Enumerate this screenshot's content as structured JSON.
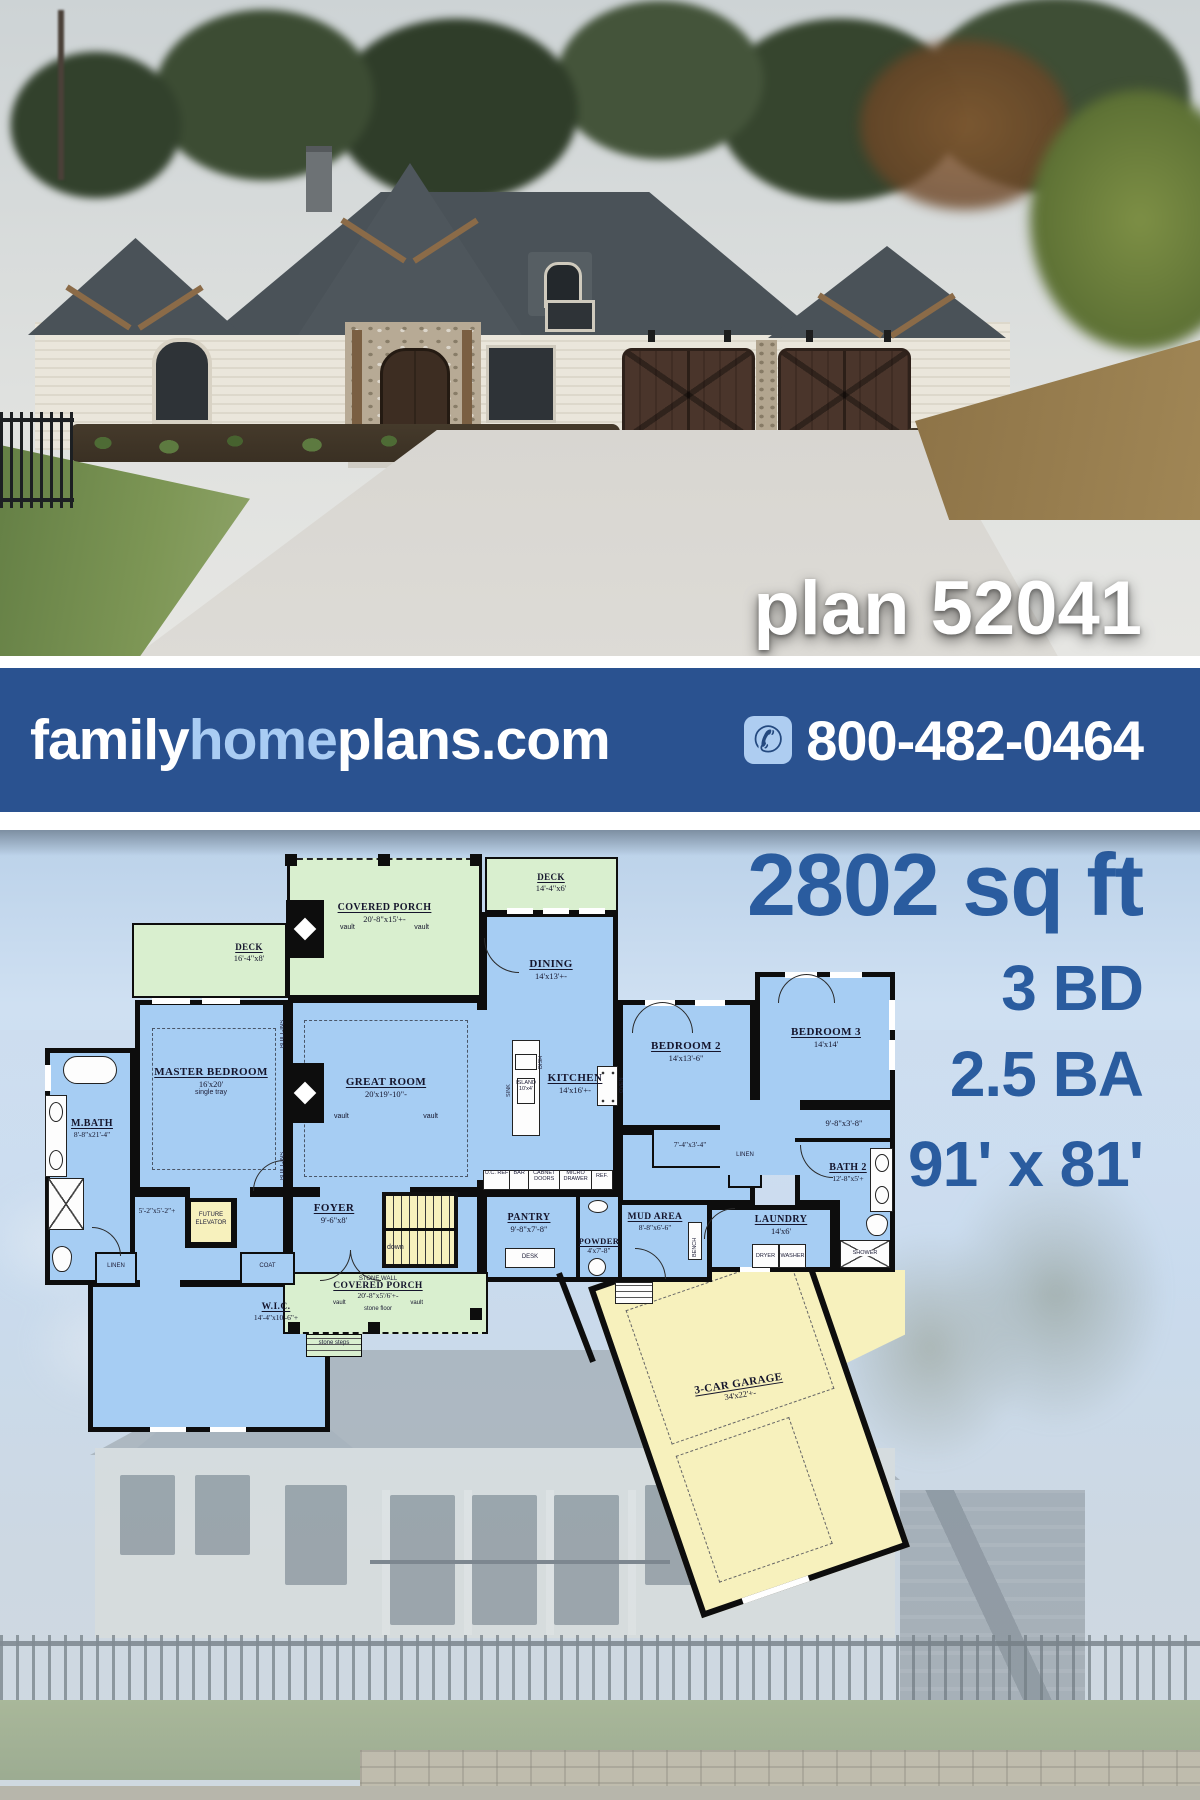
{
  "hero": {
    "plan_label": "plan 52041"
  },
  "banner": {
    "brand": {
      "family": "family",
      "home": "home",
      "plans": "plans.com"
    },
    "phone": "800-482-0464",
    "bg_color": "#2a5290",
    "home_color": "#a9ccf3"
  },
  "stats": {
    "area": "2802 sq ft",
    "beds": "3 BD",
    "baths": "2.5 BA",
    "size": "91' x 81'",
    "color": "#2a5c9f"
  },
  "plan": {
    "colors": {
      "room_blue": "#a6cdf3",
      "porch_green": "#d9efcf",
      "garage_yellow": "#f7f1bd",
      "wall": "#0d0d0d"
    },
    "porch_top": {
      "name": "COVERED PORCH",
      "dim": "20'-8\"x15'+-",
      "vault_l": "vault",
      "vault_r": "vault"
    },
    "deck_left": {
      "name": "DECK",
      "dim": "16'-4\"x8'"
    },
    "deck_right": {
      "name": "DECK",
      "dim": "14'-4\"x6'"
    },
    "dining": {
      "name": "DINING",
      "dim": "14'x13'+-"
    },
    "master": {
      "name": "MASTER BEDROOM",
      "dim": "16'x20'",
      "note": "single tray"
    },
    "great": {
      "name": "GREAT ROOM",
      "dim": "20'x19'-10\"-",
      "vault_l": "vault",
      "vault_r": "vault"
    },
    "kitchen": {
      "name": "KITCHEN",
      "dim": "14'x16'+-"
    },
    "island": {
      "name": "ISLAND",
      "dim": "10'x4'"
    },
    "mbath": {
      "name": "M.BATH",
      "dim": "8'-8\"x21'-4\""
    },
    "bedroom2": {
      "name": "BEDROOM 2",
      "dim": "14'x13'-6\""
    },
    "bedroom3": {
      "name": "BEDROOM 3",
      "dim": "14'x14'"
    },
    "bath2": {
      "name": "BATH 2",
      "dim": "12'-8\"x5'+"
    },
    "laundry": {
      "name": "LAUNDRY",
      "dim": "14'x6'"
    },
    "mud": {
      "name": "MUD AREA",
      "dim": "8'-8\"x6'-6\""
    },
    "powder": {
      "name": "POWDER",
      "dim": "4'x7'-8\""
    },
    "pantry": {
      "name": "PANTRY",
      "dim": "9'-8\"x7'-8\""
    },
    "foyer": {
      "name": "FOYER",
      "dim": "9'-6\"x8'"
    },
    "wic": {
      "name": "W.I.C.",
      "dim": "14'-4\"x10'-6\"+"
    },
    "porch_bottom": {
      "stone_wall": "STONE WALL",
      "name": "COVERED PORCH",
      "dim": "20'-8\"x5'/6'+-",
      "vault_l": "vault",
      "vault_r": "vault",
      "floor": "stone floor",
      "steps": "stone steps"
    },
    "garage": {
      "name": "3-CAR GARAGE",
      "dim": "34'x22'+-"
    },
    "hall_master": "5'-2\"x5'-2\"+",
    "hall_bed": "7'-4\"x3'-4\"",
    "hall_right": "9'-8\"x3'-8\"",
    "elevator": "FUTURE ELEVATOR",
    "coat": "COAT",
    "desk": "DESK",
    "down": "down",
    "linen": "LINEN",
    "bench": "BENCH",
    "builtins": "BUILT-INS",
    "shower": "SHOWER",
    "dryer": "DRYER",
    "washer": "WASHER",
    "appliances": {
      "ucref": "U.C. REF",
      "bar": "BAR",
      "cab": "CABNET DOORS",
      "micro": "MICRO DRAWER",
      "ref": "REF.",
      "dish": "DISH",
      "sink": "SINK",
      "oven": "OVEN"
    }
  }
}
